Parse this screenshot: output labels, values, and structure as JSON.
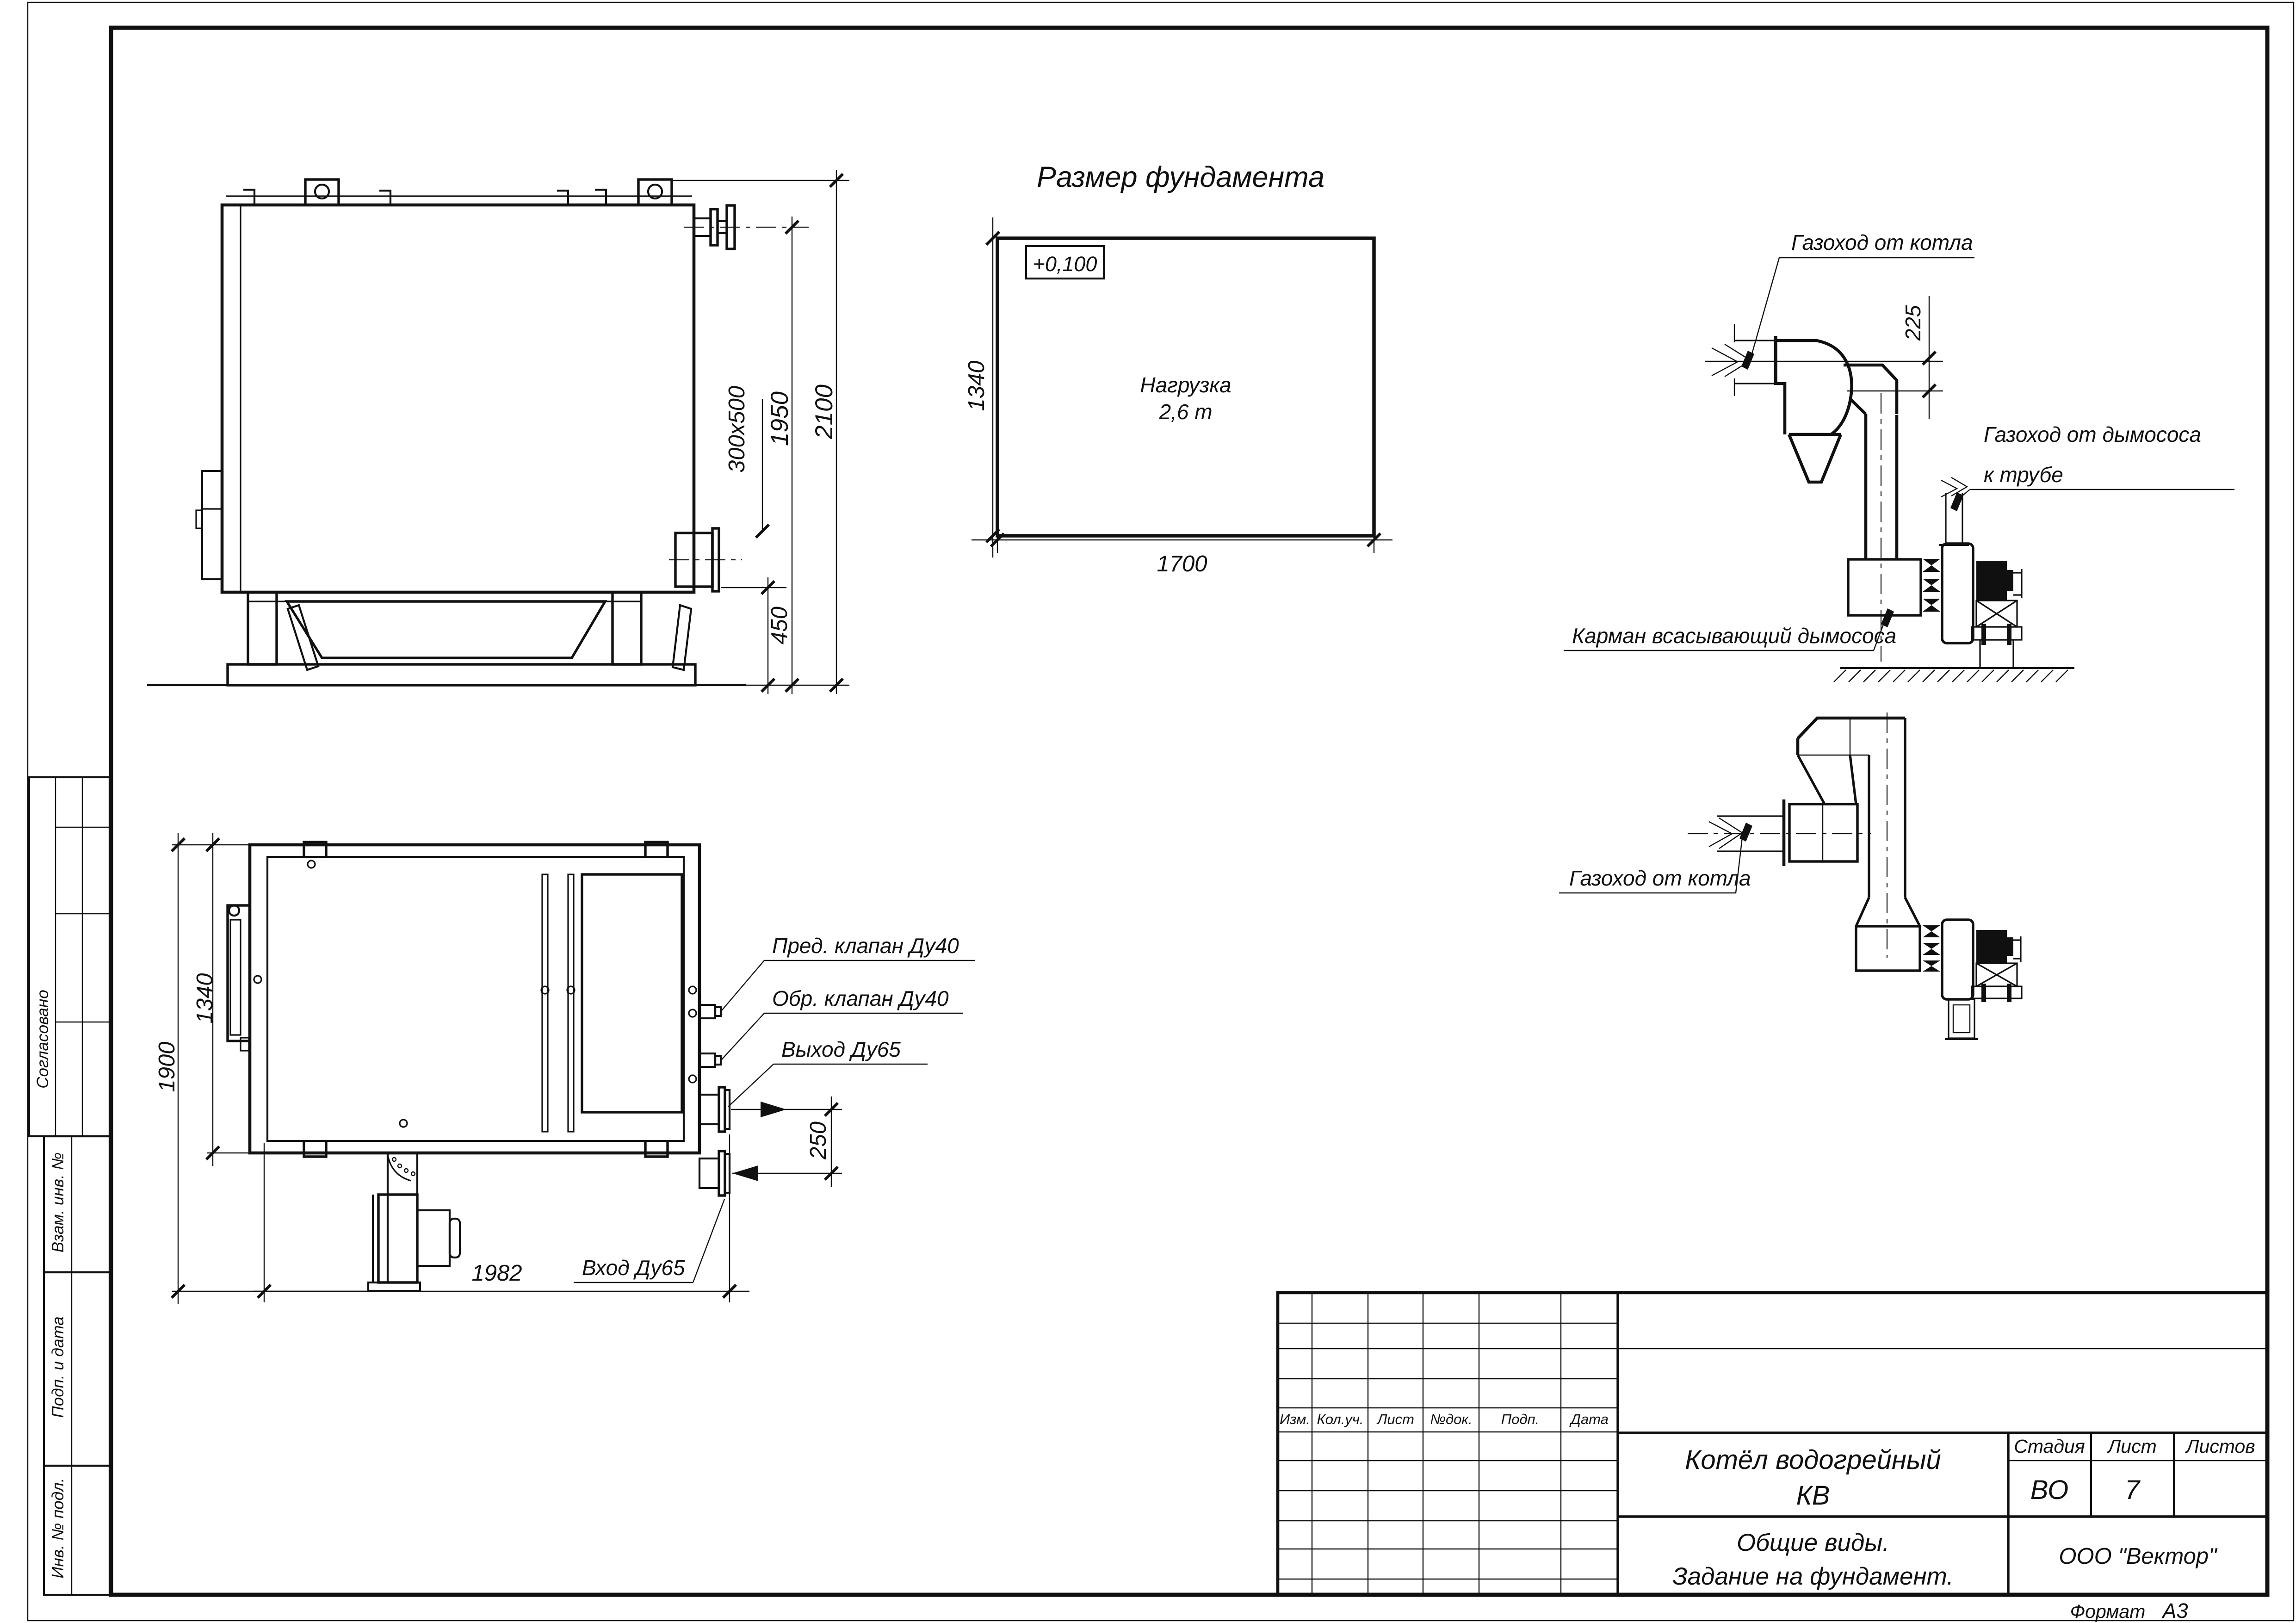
{
  "sheet": {
    "format_label": "Формат",
    "format_value": "А3"
  },
  "margin_column": {
    "approved": "Согласовано",
    "box1": "Взам. инв. №",
    "box2": "Подп. и дата",
    "box3": "Инв. № подл."
  },
  "side_view": {
    "dim_total_height": "2100",
    "dim_flange_height": "1950",
    "dim_outlet_height": "450",
    "outlet_size": "300x500"
  },
  "foundation": {
    "title": "Размер фундамента",
    "elevation": "+0,100",
    "load_line1": "Нагрузка",
    "load_line2": "2,6 т",
    "dim_length": "1700",
    "dim_width": "1340"
  },
  "plan_view": {
    "dim_width_outer": "1900",
    "dim_width_inner": "1340",
    "dim_length": "1982",
    "dim_nozzles": "250",
    "label_safety_valve": "Пред. клапан Ду40",
    "label_check_valve": "Обр. клапан Ду40",
    "label_outlet": "Выход Ду65",
    "label_inlet": "Вход Ду65"
  },
  "flue1": {
    "label_boiler_duct": "Газоход от котла",
    "dim_duct": "225",
    "label_fan_duct_line1": "Газоход от дымососа",
    "label_fan_duct_line2": "к трубе",
    "label_pocket": "Карман всасывающий дымососа"
  },
  "flue2": {
    "label_boiler_duct": "Газоход от котла"
  },
  "title_block": {
    "h_izm": "Изм.",
    "h_kol": "Кол.уч.",
    "h_list": "Лист",
    "h_doc": "№док.",
    "h_podp": "Подп.",
    "h_data": "Дата",
    "doc_name_line1": "Котёл водогрейный",
    "doc_name_line2": "КВ",
    "h_stage": "Стадия",
    "h_sheet": "Лист",
    "h_sheets": "Листов",
    "stage": "ВО",
    "sheet_no": "7",
    "subtitle_line1": "Общие виды.",
    "subtitle_line2": "Задание на фундамент.",
    "company": "ООО \"Вектор\""
  }
}
